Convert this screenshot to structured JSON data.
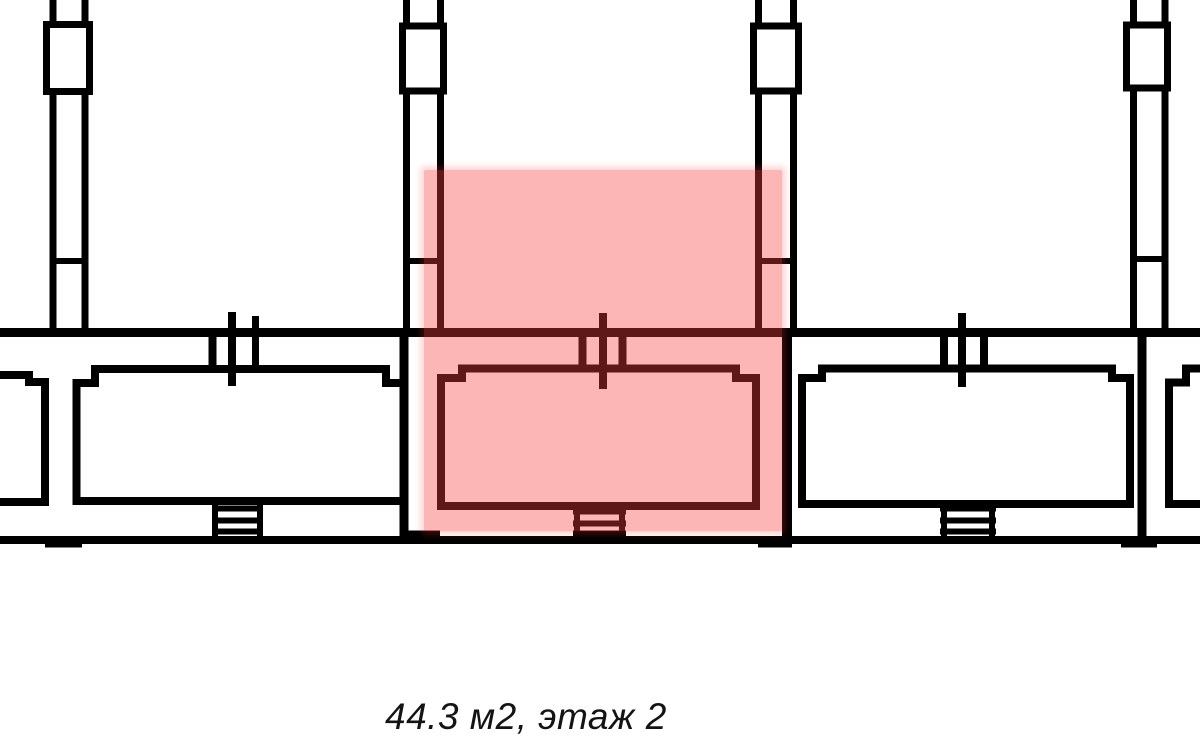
{
  "canvas": {
    "width": 1200,
    "height": 745,
    "background": "#ffffff"
  },
  "caption": {
    "text": "44.3 м2, этаж 2",
    "area": "44.3 м2",
    "floor": "этаж 2"
  },
  "selection": {
    "selected_unit": "middle"
  },
  "colors": {
    "wall": "#000000",
    "highlight": "rgba(250,62,62,0.38)",
    "highlight-glow": "rgba(250,62,62,0.20)",
    "caption-text": "#141414",
    "canvas-bg": "#ffffff"
  }
}
